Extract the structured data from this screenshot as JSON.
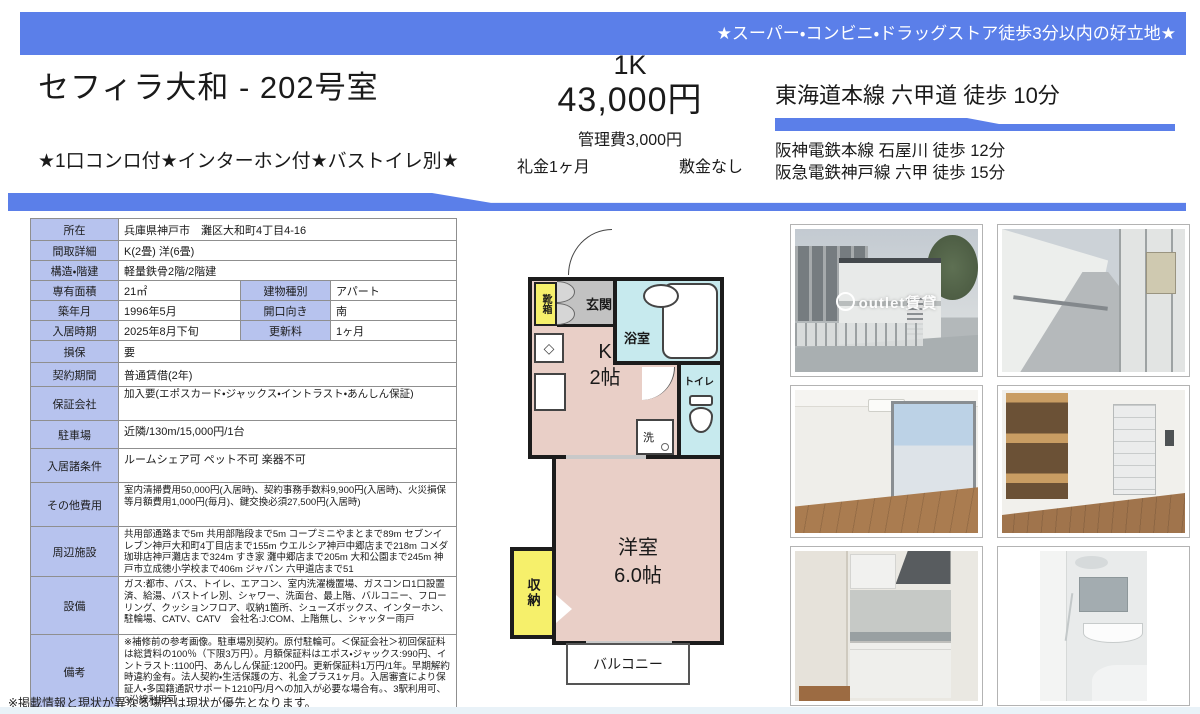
{
  "banner": {
    "text": "★スーパー・コンビニ・ドラッグストア徒歩3分以内の好立地★"
  },
  "header": {
    "title": "セフィラ大和 - 202号室",
    "features": "★1口コンロ付★インターホン付★バストイレ別★",
    "layout_type": "1K",
    "rent": "43,000円",
    "management_fee": "管理費3,000円",
    "key_money": "礼金1ヶ月",
    "deposit": "敷金なし",
    "access_main": "東海道本線 六甲道 徒歩 10分",
    "access_sub": [
      "阪神電鉄本線 石屋川 徒歩 12分",
      "阪急電鉄神戸線 六甲 徒歩 15分"
    ]
  },
  "table": {
    "rows": [
      {
        "label": "所在",
        "value": "兵庫県神戸市　灘区大和町4丁目4-16"
      },
      {
        "label": "間取詳細",
        "value": "K(2畳) 洋(6畳)"
      },
      {
        "label": "構造・階建",
        "value": "軽量鉄骨2階/2階建"
      },
      {
        "label": "専有面積",
        "value": "21㎡",
        "label2": "建物種別",
        "value2": "アパート"
      },
      {
        "label": "築年月",
        "value": "1996年5月",
        "label2": "開口向き",
        "value2": "南"
      },
      {
        "label": "入居時期",
        "value": "2025年8月下旬",
        "label2": "更新料",
        "value2": "1ヶ月"
      },
      {
        "label": "損保",
        "value": "要"
      },
      {
        "label": "契約期間",
        "value": "普通賃借(2年)"
      },
      {
        "label": "保証会社",
        "value": "加入要(エポスカード・ジャックス・イントラスト・あんしん保証)"
      },
      {
        "label": "駐車場",
        "value": "近隣/130m/15,000円/1台"
      },
      {
        "label": "入居諸条件",
        "value": "ルームシェア可 ペット不可 楽器不可"
      },
      {
        "label": "その他費用",
        "value": "室内清掃費用50,000円(入居時)、契約事務手数料9,900円(入居時)、火災損保等月額費用1,000円(毎月)、鍵交換必須27,500円(入居時)"
      },
      {
        "label": "周辺施設",
        "value": "共用部通路まで5m 共用部階段まで5m コープミニやまとまで89m セブンイレブン神戸大和町4丁目店まで155m ウエルシア神戸中郷店まで218m コメダ珈琲店神戸灘店まで324m すき家 灘中郷店まで205m 大和公園まで245m 神戸市立成徳小学校まで406m ジャパン 六甲道店まで51"
      },
      {
        "label": "設備",
        "value": "ガス:都市、バス、トイレ、エアコン、室内洗濯機置場、ガスコンロ1口設置済、給湯、バストイレ別、シャワー、洗面台、最上階、バルコニー、フローリング、クッションフロア、収納1箇所、シューズボックス、インターホン、駐輪場、CATV、CATV　会社名:J:COM、上階無し、シャッター雨戸"
      },
      {
        "label": "備考",
        "value": "※補修前の参考画像。駐車場別契約。原付駐輪可。＜保証会社＞初回保証料は総賃料の100％（下限3万円）。月額保証料はエポス・ジャックス:990円、イントラスト:1100円、あんしん保証:1200円。更新保証料1万円/1年。早期解約時違約金有。法人契約・生活保護の方、礼金プラス1ヶ月。入居審査により保証人・多国籍通訳サポート1210円/月への加入が必要な場合有。、3駅利用可、3沿線利用可"
      }
    ]
  },
  "floorplan": {
    "entrance": "玄関",
    "shoe_box": "靴箱",
    "bathroom": "浴室",
    "toilet": "トイレ",
    "kitchen_line1": "K",
    "kitchen_line2": "2帖",
    "stove_icon": "◇",
    "washer": "洗",
    "room_line1": "洋室",
    "room_line2": "6.0帖",
    "storage": "収納",
    "balcony": "バルコニー"
  },
  "photos": {
    "watermark": "outlet賃貸",
    "items": [
      {
        "name": "exterior-building"
      },
      {
        "name": "common-corridor"
      },
      {
        "name": "room-window"
      },
      {
        "name": "room-closet"
      },
      {
        "name": "kitchen"
      },
      {
        "name": "bathroom"
      }
    ]
  },
  "footer": {
    "note": "※掲載情報と現状が異なる場合は現状が優先となります。"
  },
  "colors": {
    "accent_blue": "#5b7fe9",
    "table_header": "#b7c3ee",
    "plan_room_pink": "#e9cfc7",
    "plan_wet_cyan": "#c7eaee",
    "plan_storage_yellow": "#f6f06b",
    "plan_genkan_gray": "#c2c2c2"
  }
}
